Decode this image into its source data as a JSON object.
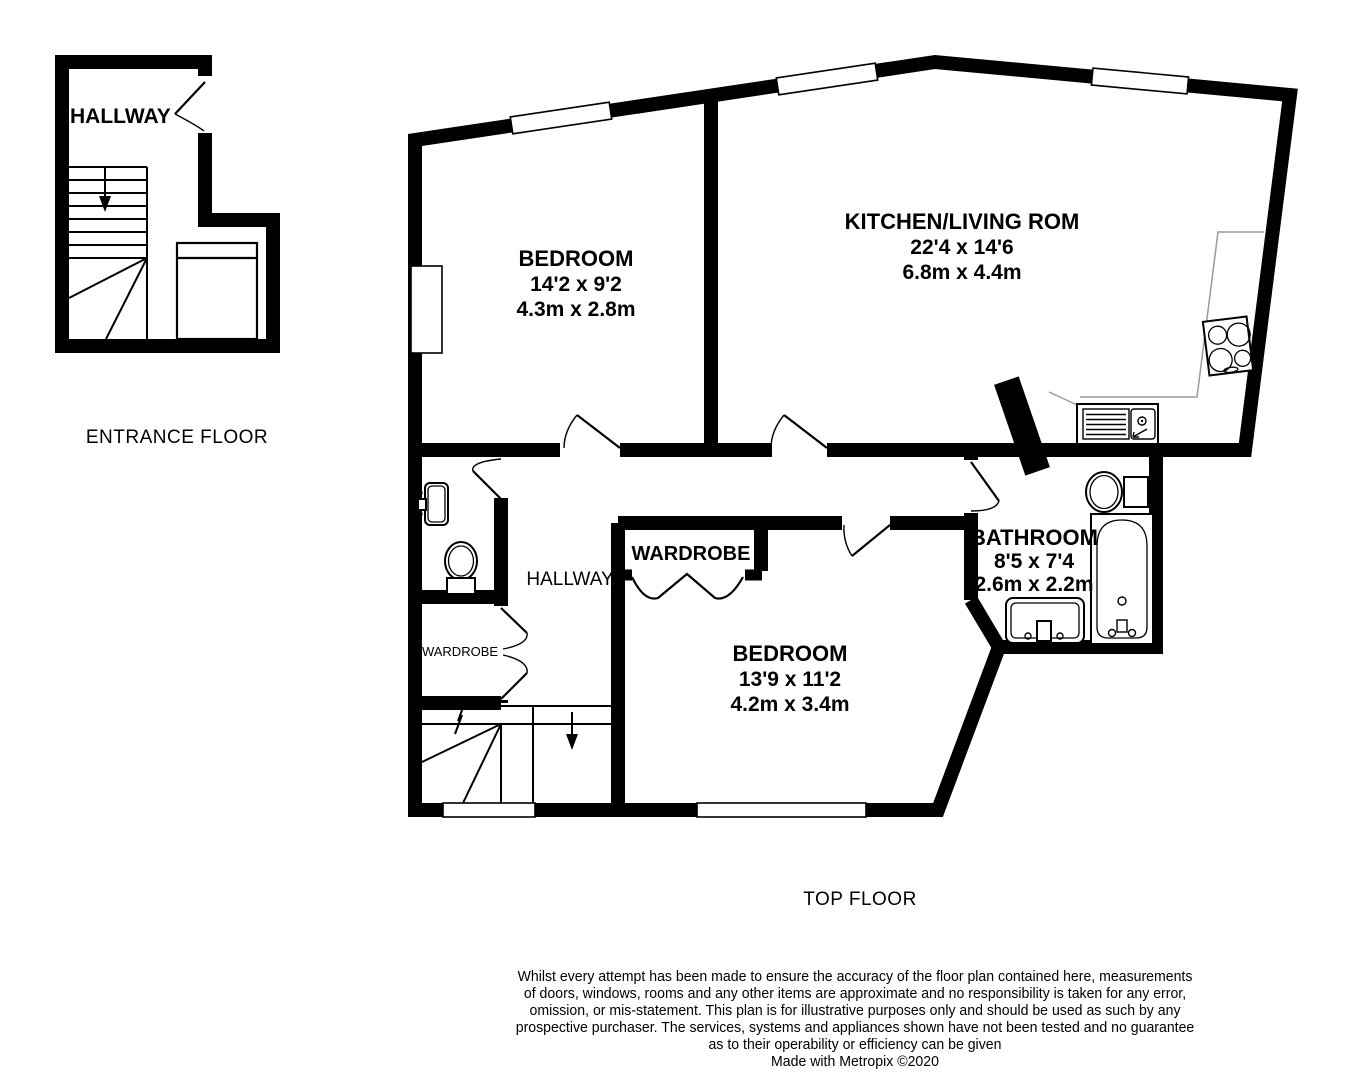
{
  "entrance_floor": {
    "hallway_label": "HALLWAY",
    "title": "ENTRANCE FLOOR"
  },
  "top_floor": {
    "title": "TOP FLOOR",
    "bedroom1": {
      "name": "BEDROOM",
      "imperial": "14'2 x 9'2",
      "metric": "4.3m x 2.8m"
    },
    "kitchen_living": {
      "name": "KITCHEN/LIVING ROM",
      "imperial": "22'4 x 14'6",
      "metric": "6.8m x 4.4m"
    },
    "bathroom": {
      "name": "BATHROOM",
      "imperial": "8'5 x 7'4",
      "metric": "2.6m x 2.2m"
    },
    "bedroom2": {
      "name": "BEDROOM",
      "imperial": "13'9 x 11'2",
      "metric": "4.2m x 3.4m"
    },
    "hallway_label": "HALLWAY",
    "wardrobe_label": "WARDROBE",
    "wardrobe_small_label": "WARDROBE"
  },
  "disclaimer": {
    "lines": [
      "Whilst every attempt has been made to ensure the accuracy of the floor plan contained here, measurements",
      "of doors, windows, rooms and any other items are approximate and no responsibility is taken for any error,",
      "omission, or mis-statement. This plan is for illustrative purposes only and should be used as such by any",
      "prospective purchaser. The services, systems and appliances shown have not been tested and no guarantee",
      "as to their operability or efficiency can be given",
      "Made with Metropix ©2020"
    ]
  },
  "colors": {
    "wall": "#000000",
    "background": "#ffffff",
    "counter": "#9a9a9a"
  }
}
